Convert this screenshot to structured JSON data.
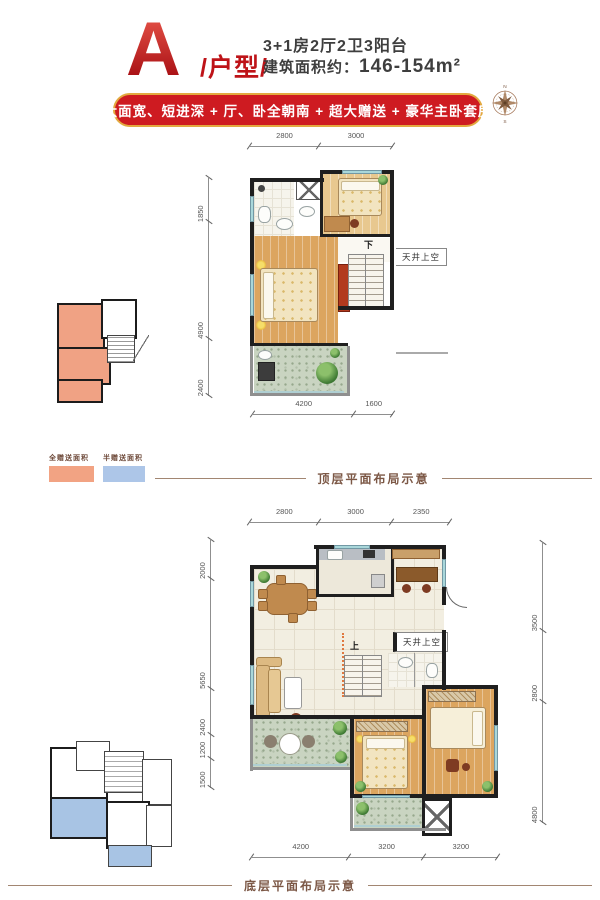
{
  "header": {
    "logo_letter": "A",
    "logo_suffix": "/户型/",
    "title_line1": "3+1房2厅2卫3阳台",
    "area_label": "建筑面积约：",
    "area_value": "146-154m²"
  },
  "banner": {
    "text": "大面宽、短进深 + 厅、卧全朝南 + 超大赠送 + 豪华主卧套房"
  },
  "compass": {
    "north": "N",
    "south": "S"
  },
  "legend": {
    "items": [
      {
        "label": "全赠送面积",
        "color": "#F2A383"
      },
      {
        "label": "半赠送面积",
        "color": "#ADC6E8"
      }
    ]
  },
  "captions": {
    "top": "顶层平面布局示意",
    "bottom": "底层平面布局示意"
  },
  "plan_top": {
    "dims_top": [
      "2800",
      "3000"
    ],
    "dims_left": [
      "1850",
      "4900",
      "2400"
    ],
    "dims_bottom": [
      "4200",
      "1600"
    ],
    "stair_label": "下",
    "void_label": "天井上空"
  },
  "plan_bottom": {
    "dims_top": [
      "2800",
      "3000",
      "2350"
    ],
    "dims_left": [
      "2000",
      "5650",
      "2400",
      "1200",
      "1500"
    ],
    "dims_right": [
      "3500",
      "2800",
      "4800"
    ],
    "dims_bottom": [
      "4200",
      "3200",
      "3200"
    ],
    "stair_label": "上",
    "void_label": "天井上空"
  },
  "colors": {
    "brand_red": "#BE1318",
    "banner_red": "#CE1B21",
    "banner_gold": "#E3A93F",
    "caption_brown": "#7C5846",
    "gift_full": "#F2A383",
    "gift_half": "#ADC6E8"
  }
}
